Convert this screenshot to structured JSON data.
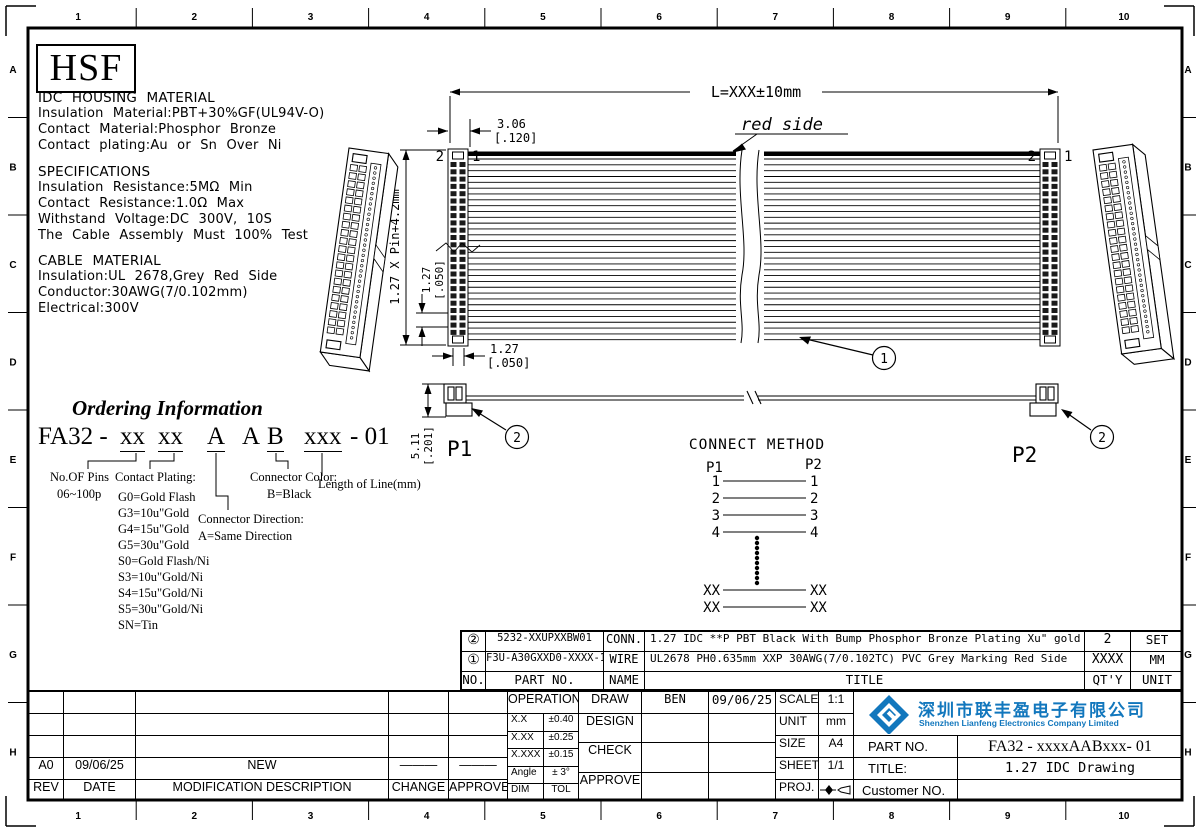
{
  "border": {
    "cols": [
      "1",
      "2",
      "3",
      "4",
      "5",
      "6",
      "7",
      "8",
      "9",
      "10"
    ],
    "rows": [
      "A",
      "B",
      "C",
      "D",
      "E",
      "F",
      "G",
      "H"
    ]
  },
  "logo_text": "HSF",
  "materials": {
    "idc_title": "IDC HOUSING MATERIAL",
    "idc_lines": [
      "Insulation Material:PBT+30%GF(UL94V-O)",
      "Contact Material:Phosphor Bronze",
      "Contact plating:Au or Sn Over Ni"
    ],
    "spec_title": "SPECIFICATIONS",
    "spec_lines": [
      "Insulation Resistance:5MΩ Min",
      "Contact Resistance:1.0Ω Max",
      "Withstand Voltage:DC 300V, 10S",
      "The Cable Assembly Must 100% Test"
    ],
    "cable_title": "CABLE MATERIAL",
    "cable_lines": [
      "Insulation:UL 2678,Grey Red Side",
      "Conductor:30AWG(7/0.102mm)",
      "Electrical:300V"
    ]
  },
  "ordering": {
    "title": "Ordering Information",
    "code_prefix": "FA32 -",
    "seg_pins": "xx",
    "seg_plating": "xx",
    "seg_dir": "A",
    "seg_a2": "A",
    "seg_color": "B",
    "seg_len": "xxx",
    "code_suffix": "- 01",
    "pins_label": "No.OF Pins",
    "pins_range": "06~100p",
    "plating_label": "Contact Plating:",
    "plating_options": [
      "G0=Gold Flash",
      "G3=10u\"Gold",
      "G4=15u\"Gold",
      "G5=30u\"Gold",
      "S0=Gold Flash/Ni",
      "S3=10u\"Gold/Ni",
      "S4=15u\"Gold/Ni",
      "S5=30u\"Gold/Ni",
      "SN=Tin"
    ],
    "direction_label": "Connector Direction:",
    "direction_option": "A=Same Direction",
    "color_label": "Connector Color:",
    "color_option": "B=Black",
    "length_label": "Length of Line(mm)"
  },
  "drawing": {
    "length_dim": "L=XXX±10mm",
    "red_side": "red side",
    "dim_306": "3.06",
    "dim_306_in": "[.120]",
    "pin_vert_dim": "1.27 X Pin+4.2mm",
    "dim_127": "1.27",
    "dim_127_in": "[.050]",
    "dim_511": "5.11",
    "dim_511_in": "[.201]",
    "p1": "P1",
    "p2": "P2",
    "pin2": "2",
    "pin1": "1",
    "balloon_cable": "1",
    "balloon_conn": "2"
  },
  "connect_method": {
    "title": "CONNECT METHOD",
    "p1": "P1",
    "p2": "P2",
    "rows": [
      "1",
      "2",
      "3",
      "4"
    ],
    "xx": "XX"
  },
  "parts_table": {
    "headers": [
      "NO.",
      "PART NO.",
      "NAME",
      "TITLE",
      "QT'Y",
      "UNIT"
    ],
    "rows": [
      {
        "no": "②",
        "part": "5232-XXUPXXBW01",
        "name": "CONN.",
        "title": "1.27 IDC **P PBT Black With Bump Phosphor Bronze Plating Xu\" gold",
        "qty": "2",
        "unit": "SET"
      },
      {
        "no": "①",
        "part": "F3U-A30GXXD0-XXXX-1",
        "name": "WIRE",
        "title": "UL2678 PH0.635mm XXP 30AWG(7/0.102TC) PVC Grey Marking Red Side",
        "qty": "XXXX",
        "unit": "MM"
      }
    ]
  },
  "revision": {
    "grid": [
      [
        "",
        "",
        "",
        "",
        ""
      ],
      [
        "",
        "",
        "",
        "",
        ""
      ],
      [
        "",
        "",
        "",
        "",
        ""
      ],
      [
        "A0",
        "09/06/25",
        "NEW",
        "———",
        "———"
      ],
      [
        "REV",
        "DATE",
        "MODIFICATION  DESCRIPTION",
        "CHANGE",
        "APPROVE"
      ]
    ]
  },
  "tolerance": {
    "title": "OPERATION",
    "rows": [
      [
        "X.X",
        "±0.40"
      ],
      [
        "X.XX",
        "±0.25"
      ],
      [
        "X.XXX",
        "±0.15"
      ],
      [
        "Angle",
        "± 3°"
      ],
      [
        "DIM",
        "TOL"
      ]
    ]
  },
  "signoff": {
    "labels": [
      "DRAW",
      "DESIGN",
      "CHECK",
      "APPROVE"
    ],
    "names": [
      "BEN",
      "",
      "",
      ""
    ],
    "dates": [
      "09/06/25",
      "",
      "",
      ""
    ]
  },
  "info": {
    "labels": [
      "SCALE",
      "UNIT",
      "SIZE",
      "SHEET",
      "PROJ."
    ],
    "values": [
      "1:1",
      "mm",
      "A4",
      "1/1",
      ""
    ]
  },
  "company": {
    "cn": "深圳市联丰盈电子有限公司",
    "en": "Shenzhen Lianfeng Electronics Company Limited",
    "part_no_label": "PART NO.",
    "part_no": "FA32 - xxxxAABxxx- 01",
    "title_label": "TITLE:",
    "title": "1.27 IDC Drawing",
    "customer_label": "Customer NO."
  },
  "colors": {
    "line": "#000000",
    "brand_blue": "#1277bd"
  }
}
